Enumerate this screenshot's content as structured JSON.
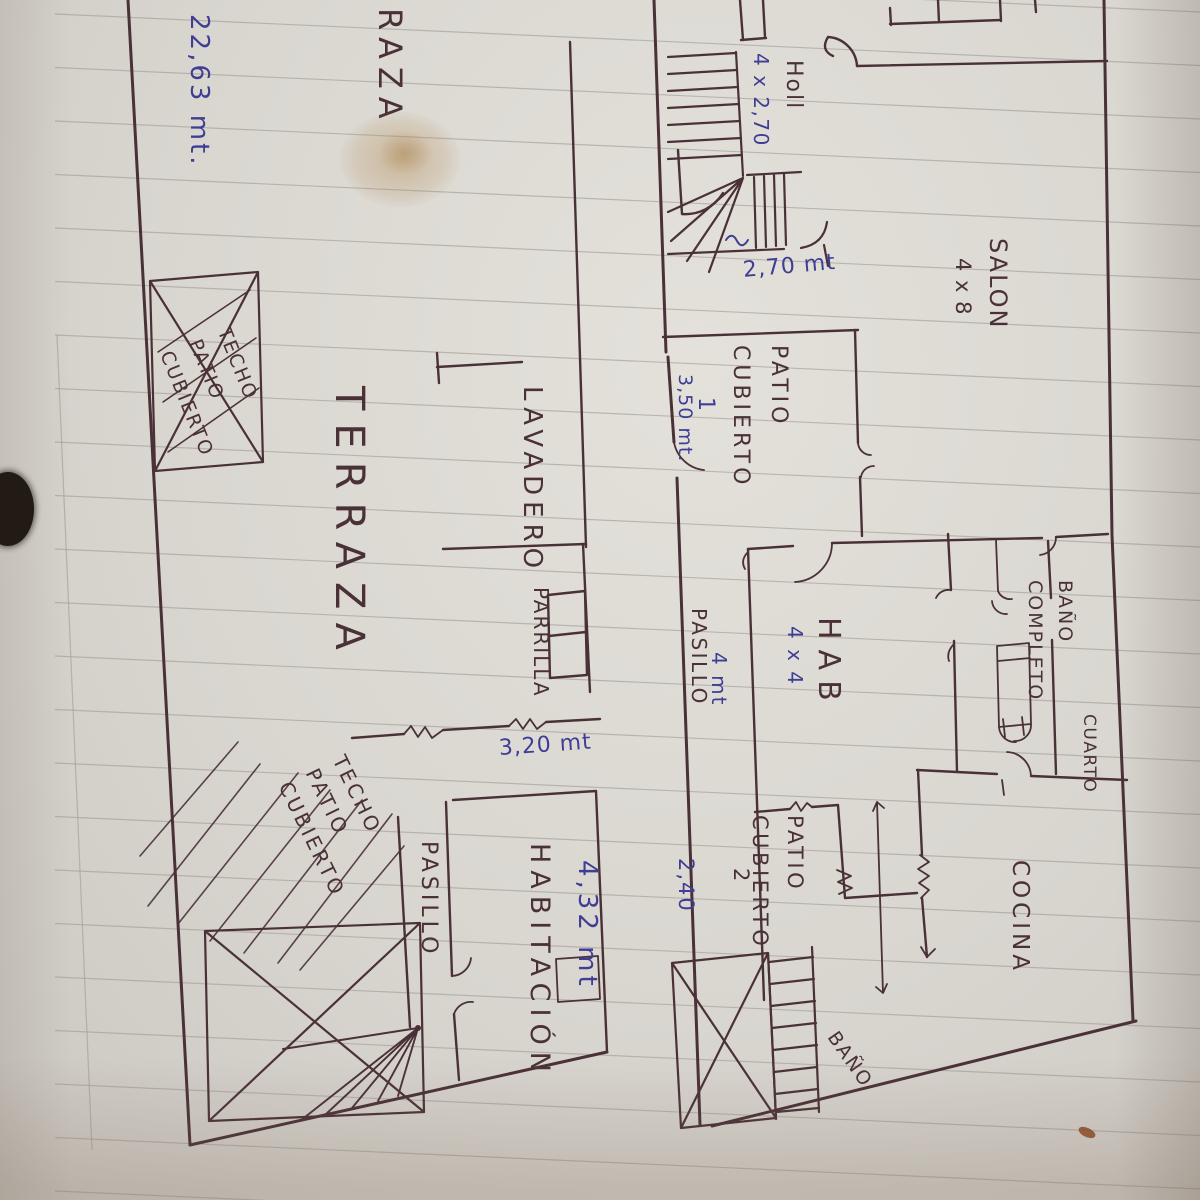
{
  "colors": {
    "ink": "#4a3137",
    "blue": "#3e3e95",
    "paper": "#dcd8d2",
    "table": "#2c211a",
    "ruled_line": "#a09a93"
  },
  "labels": {
    "total_length": "22,63 mt.",
    "terraza_top": "TERRAZA",
    "techo_patio_cubierto_top": "TECHO\nPATIO\nCUBIERTO",
    "terraza_main": "TERRAZA",
    "lavadero": "LAVADERO",
    "parrilla": "PARRILLA",
    "parrilla_dim": "3,20 mt",
    "holl": "Holl",
    "holl_dim": "4 x 2,70",
    "stair_dim": "2,70 mt",
    "salon": "SALON",
    "salon_dim": "4 x 8",
    "patio_cubierto_1": "PATIO\nCUBIERTO",
    "patio_cubierto_1_num": "1",
    "patio_cubierto_1_dim": "3,50 mt.",
    "pasillo_right": "PASILLO",
    "pasillo_right_dim": "4 mt",
    "hab": "HAB",
    "hab_dim": "4 x 4",
    "bano_completo": "BAÑO\nCOMPLETO",
    "cuarto": "CUARTO",
    "cocina": "COCINA",
    "patio_cubierto_2": "PATIO\nCUBIERTO",
    "patio_cubierto_2_num": "2",
    "patio_cubierto_2_dim": "2,40",
    "habitacion": "HABITACIÓN",
    "habitacion_dim": "4,32 mt",
    "pasillo_bottom": "PASILLO",
    "techo_patio_cubierto_bottom": "TECHO\nPATIO\nCUBIERTO",
    "bano_small": "BAÑO"
  }
}
